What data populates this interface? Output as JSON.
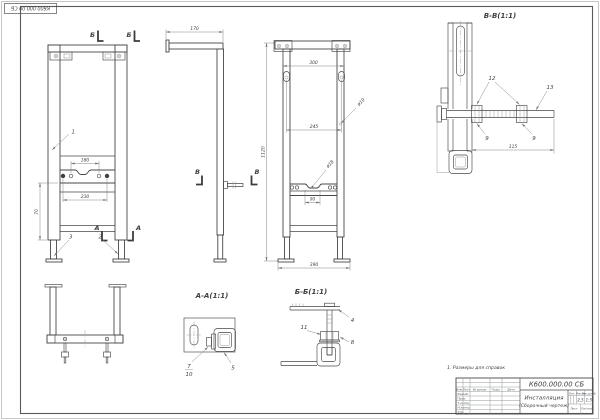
{
  "colors": {
    "paper": "#ffffff",
    "main_line": "#474747",
    "thin_line": "#8a8f93",
    "text": "#3f4144",
    "hatch": "#9aa0a4"
  },
  "stamp": {
    "doc_number": "К600.000.00 СБ"
  },
  "note": "1. Размеры для справок",
  "views": {
    "front": {
      "section_b_label": "Б",
      "section_a_label": "А",
      "dim_holes_180": "180",
      "dim_bolts_230": "230",
      "dim_height_70": "70",
      "callout_frame": "1",
      "callout_foot_left": "3",
      "callout_foot_right": "2"
    },
    "side": {
      "dim_depth_170": "170",
      "section_v_label": "В"
    },
    "front2": {
      "section_v_label": "В",
      "dim_top_300": "300",
      "dim_holes_245": "245",
      "dim_offset_90": "90",
      "dim_width_390": "390",
      "dim_height_1120": "1120",
      "callout_hole_small": "ø10",
      "callout_hole_big": "ø18"
    },
    "section_vv": {
      "title": "В-В(1:1)",
      "callout_nuts": "12",
      "callout_rod": "13",
      "callout_washer": "9",
      "dim_rod_115": "115"
    },
    "section_aa": {
      "title": "А-А(1:1)",
      "callout_bolt": "7",
      "callout_washer": "10",
      "callout_tube": "5"
    },
    "section_bb": {
      "title": "Б-Б(1:1)",
      "callout_bracket": "4",
      "callout_nut": "11",
      "callout_washer": "8"
    }
  },
  "title_block": {
    "doc_number": "К600.000.00 СБ",
    "product_name": "Инсталляция",
    "doc_type": "(Сборочный чертеж)",
    "columns": {
      "izm": "Изм.",
      "list": "Лист",
      "doc": "№ докум.",
      "podp": "Подп.",
      "data": "Дата"
    },
    "rows": {
      "razrab": "Разраб.",
      "prov": "Пров.",
      "tkontr": "Т.контр.",
      "nkontr": "Н.контр.",
      "utv": "Утв."
    },
    "lit_label": "Лит.",
    "mass_label": "Масса",
    "scale_label": "Масштаб",
    "mass_value": "2,5",
    "scale_value": "1:5",
    "sheet_label": "Лист",
    "sheets_label": "Листов"
  }
}
